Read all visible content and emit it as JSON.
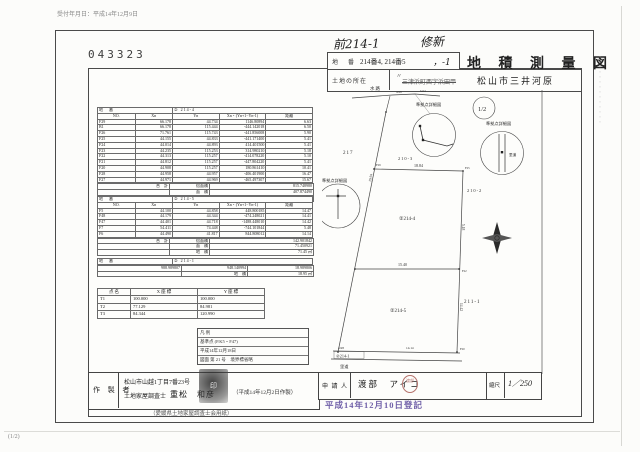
{
  "document": {
    "received_note": "受付年月日：平成14年12月9日",
    "doc_number": "043323",
    "page_note": "(1/2)",
    "side_code": "・・・・・・・・・・・・・・",
    "handwritten_prev": "前214-1",
    "handwritten_new": "修新",
    "title_block": {
      "lot_label": "地　番",
      "lot_value": "214番4, 214番5",
      "lot_value_hand": "，-1",
      "title": "地 積 測 量 図",
      "location_label": "土地の所在",
      "location_ditto": "〃",
      "location_struck": "三津浜町西字浜田甲",
      "location_value": "松山市三井河原"
    }
  },
  "tables": {
    "col_headers": [
      "NO.",
      "Xn",
      "Yn",
      "Xn・(Yn+1−Yn-1)",
      "距離"
    ],
    "lot_label": "地　番",
    "table1": {
      "lot": "② 214-4",
      "rows": [
        [
          "F29",
          "66.178",
          "44.734",
          "1146.80894",
          "6.63"
        ],
        [
          "B1",
          "66.178",
          "115.444",
          "-444.142018",
          "6.50"
        ],
        [
          "F26",
          "71.761",
          "115.743",
          "-441.856008",
          "5.90"
        ],
        [
          "F25",
          "44.155",
          "44.833",
          "-441.171400",
          "5.41"
        ],
        [
          "F24",
          "44.014",
          "44.893",
          "414.401500",
          "5.41"
        ],
        [
          "F23",
          "44.235",
          "115.253",
          "314.980210",
          "5.18"
        ],
        [
          "F22",
          "44.313",
          "115.257",
          "-414.078220",
          "5.10"
        ],
        [
          "F21",
          "44.812",
          "115.257",
          "-447.804220",
          "5.41"
        ],
        [
          "F20",
          "44.908",
          "115.257",
          "180.861410",
          "10.41"
        ],
        [
          "F28",
          "44.958",
          "44.957",
          "-406.401900",
          "16.47"
        ],
        [
          "F27",
          "44.971",
          "44.969",
          "-465.497307",
          "15.67"
        ]
      ],
      "summary": [
        [
          "合　計",
          "倍面積",
          "815.748980"
        ],
        [
          "",
          "面　積",
          "407.874490"
        ],
        [
          "",
          "地　積",
          "407.87 ㎡"
        ]
      ]
    },
    "table2": {
      "lot": "② 214-5",
      "rows": [
        [
          "F5",
          "44.100",
          "44.858",
          "448.800185",
          "14.47"
        ],
        [
          "F48",
          "44.179",
          "44.344",
          "-474.248021",
          "14.41"
        ],
        [
          "F47",
          "44.401",
          "44.718",
          "-1488.448010",
          "14.42"
        ],
        [
          "F7",
          "54.411",
          "74.448",
          "-744.101844",
          "5.48"
        ],
        [
          "F6",
          "44.490",
          "41.817",
          "844.808012",
          "14.14"
        ]
      ],
      "summary": [
        [
          "合　計",
          "倍面積",
          "142.901842"
        ],
        [
          "",
          "面　積",
          "71.450921"
        ],
        [
          "",
          "地　積",
          "71.45 ㎡"
        ]
      ]
    },
    "table3": {
      "lot": "② 214-1",
      "rows": [
        [
          "988.989807",
          "948.140994",
          "18.989806"
        ],
        [
          "",
          "地　積",
          "18.95 ㎡"
        ]
      ]
    },
    "ref_points": {
      "headers": [
        "点 名",
        "X 座 標",
        "Y 座 標"
      ],
      "rows": [
        [
          "T1",
          "100.000",
          "100.000"
        ],
        [
          "T2",
          "77.129",
          "84.981"
        ],
        [
          "T3",
          "84.344",
          "120.990"
        ]
      ]
    }
  },
  "legend": {
    "lines": [
      "凡 例",
      "基準点 (P.K5・F47)",
      "平成14年12月18日",
      "図面 第 21 号　境界標省略"
    ]
  },
  "maker": {
    "label": "作 製 者",
    "address": "松山市山越1丁目7番23号",
    "role": "土地家屋調査士",
    "name": "重松　和彦",
    "date_note": "（平成14年12月2日作製）",
    "union_note": "（愛媛県土地家屋調査士会用紙）",
    "stamp_text": "印"
  },
  "applicant": {
    "label": "申 請 人",
    "name": "渡部　アイコ",
    "stamp_text": "渡部",
    "scale_label": "縮尺",
    "scale_value": "1／250"
  },
  "registration_stamp": "平成14年12月10日登記",
  "map": {
    "detail_label": "準拠点詳細図",
    "half_note": "1/2",
    "waterway": "水路",
    "road": "里道",
    "road2": "里道",
    "p217": "217",
    "p210_3": "210-3",
    "p210_2": "210-2",
    "p211_1": "211-1",
    "lot214_4": "②214-4",
    "lot214_5": "②214-5",
    "lot214_1": "②214-1",
    "dim_top": "18.84",
    "dim_mid": "15.40",
    "dim_left": "19.94",
    "dim_right_upper": "5.18",
    "dim_right_lower": "14.42",
    "dim_bottom": "14.14",
    "dim_bottom_left": "4.98",
    "dim_water_a": "4.98",
    "dim_water_b": "5.04",
    "points": [
      "F29",
      "F25",
      "F22",
      "F20"
    ]
  }
}
